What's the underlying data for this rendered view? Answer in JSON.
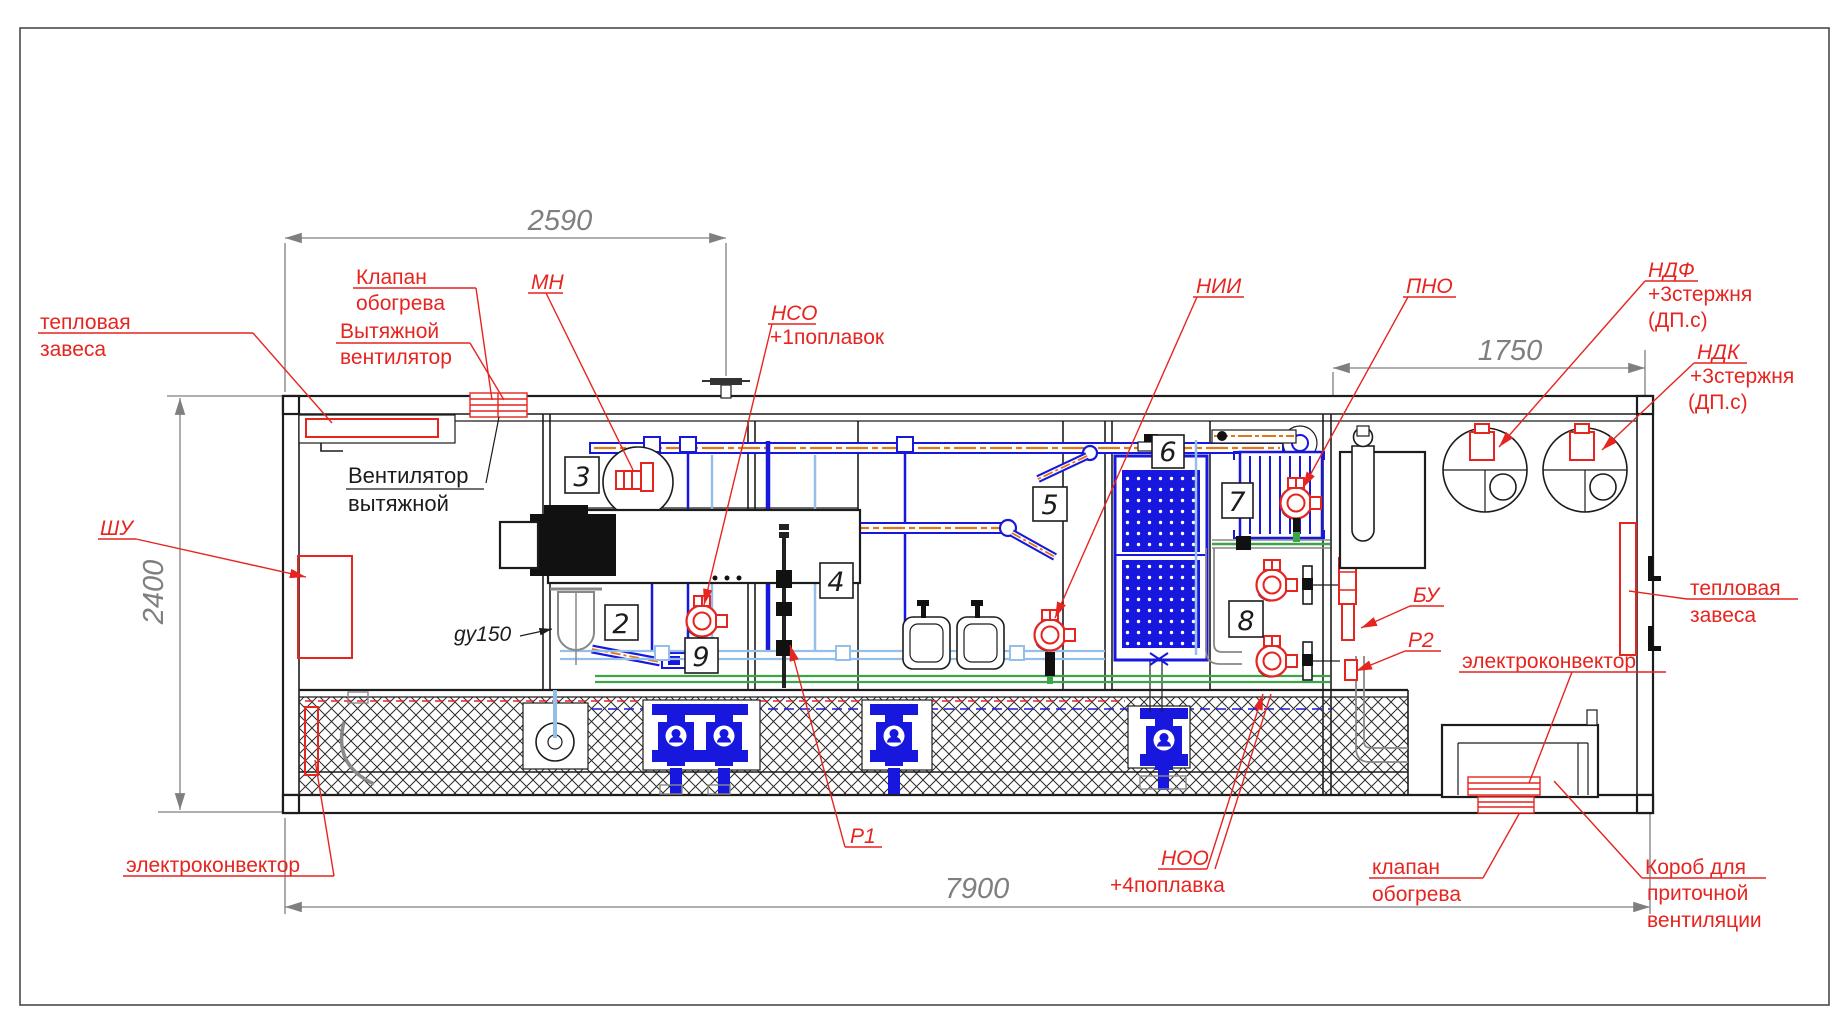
{
  "drawing_type": "container water-treatment unit side-view engineering drawing",
  "colors": {
    "annotation_red": "#e62420",
    "pipe_blue": "#1717dd",
    "pipe_light_blue": "#93bfe8",
    "pipe_green": "#3da44c",
    "pipe_orange": "#e07818",
    "dimension_gray": "#7f7f7f",
    "line_black": "#1c1c1c"
  },
  "dimensions": {
    "d2590": "2590",
    "d2400": "2400",
    "d1750": "1750",
    "d7900": "7900"
  },
  "labels": {
    "teplovaya_left_1": "тепловая",
    "teplovaya_left_2": "завеса",
    "klapan_top_1": "Клапан",
    "klapan_top_2": "обогрева",
    "vytyazhnoy_1": "Вытяжной",
    "vytyazhnoy_2": "вентилятор",
    "mn": "МН",
    "nso": "НСО",
    "nso_sub": "+1поплавок",
    "nii": "НИИ",
    "pno": "ПНО",
    "ndf": "НДФ",
    "ndf_sub1": "+3стержня",
    "ndf_sub2": "(ДП.с)",
    "ndk": "НДК",
    "ndk_sub1": "+3стержня",
    "ndk_sub2": "(ДП.с)",
    "shu": "ШУ",
    "ventilyator_1": "Вентилятор",
    "ventilyator_2": "вытяжной",
    "gy150": "gy150",
    "teplovaya_right_1": "тепловая",
    "teplovaya_right_2": "завеса",
    "bu": "БУ",
    "p2": "Р2",
    "p1": "Р1",
    "elektrokonvektor_right": "электроконвектор",
    "elektrokonvektor_left": "электроконвектор",
    "noo": "НОО",
    "noo_sub": "+4поплавка",
    "klapan_bottom_1": "клапан",
    "klapan_bottom_2": "обогрева",
    "korob_1": "Короб для",
    "korob_2": "приточной",
    "korob_3": "вентиляции"
  },
  "equipment_numbers": {
    "b2": "2",
    "b3": "3",
    "b4": "4",
    "b5": "5",
    "b6": "6",
    "b7": "7",
    "b8": "8",
    "b9": "9"
  }
}
